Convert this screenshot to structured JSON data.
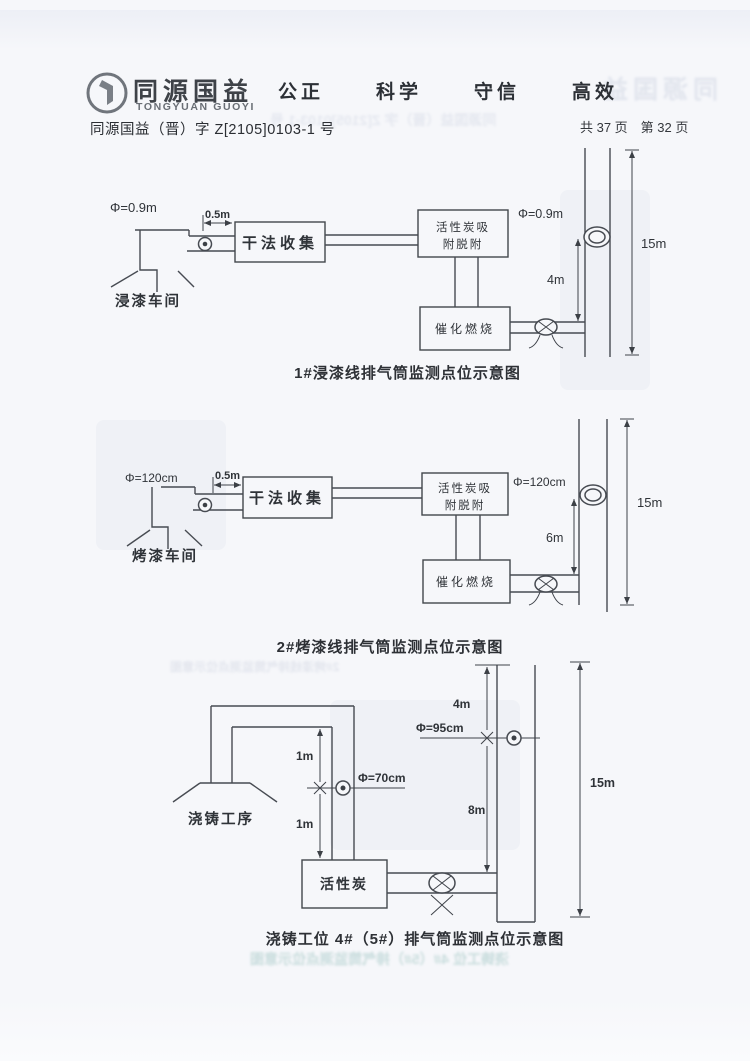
{
  "header": {
    "logo_cn": "同源国益",
    "logo_en": "TONGYUAN GUOYI",
    "slogans": [
      "公正",
      "科学",
      "守信",
      "高效"
    ],
    "doc_number": "同源国益（晋）字 Z[2105]0103-1 号",
    "page_info": "共 37 页　第 32 页"
  },
  "diagram1": {
    "caption": "1#浸漆线排气筒监测点位示意图",
    "labels": {
      "phi_inlet": "Φ=0.9m",
      "offset": "0.5m",
      "workshop": "浸漆车间",
      "box_dry": "干法收集",
      "box_carbon_l1": "活性炭吸",
      "box_carbon_l2": "附脱附",
      "box_catalytic": "催化燃烧",
      "phi_stack": "Φ=0.9m",
      "h_port": "4m",
      "h_total": "15m"
    }
  },
  "diagram2": {
    "caption": "2#烤漆线排气筒监测点位示意图",
    "labels": {
      "phi_inlet": "Φ=120cm",
      "offset": "0.5m",
      "workshop": "烤漆车间",
      "box_dry": "干法收集",
      "box_carbon_l1": "活性炭吸",
      "box_carbon_l2": "附脱附",
      "box_catalytic": "催化燃烧",
      "phi_stack": "Φ=120cm",
      "h_port": "6m",
      "h_total": "15m"
    }
  },
  "diagram3": {
    "caption": "浇铸工位 4#（5#）排气筒监测点位示意图",
    "labels": {
      "workshop": "浇铸工序",
      "h_up": "1m",
      "h_down": "1m",
      "phi_duct": "Φ=70cm",
      "box_carbon": "活性炭",
      "phi_stack": "Φ=95cm",
      "h_top": "4m",
      "h_bottom": "8m",
      "h_total": "15m"
    }
  }
}
